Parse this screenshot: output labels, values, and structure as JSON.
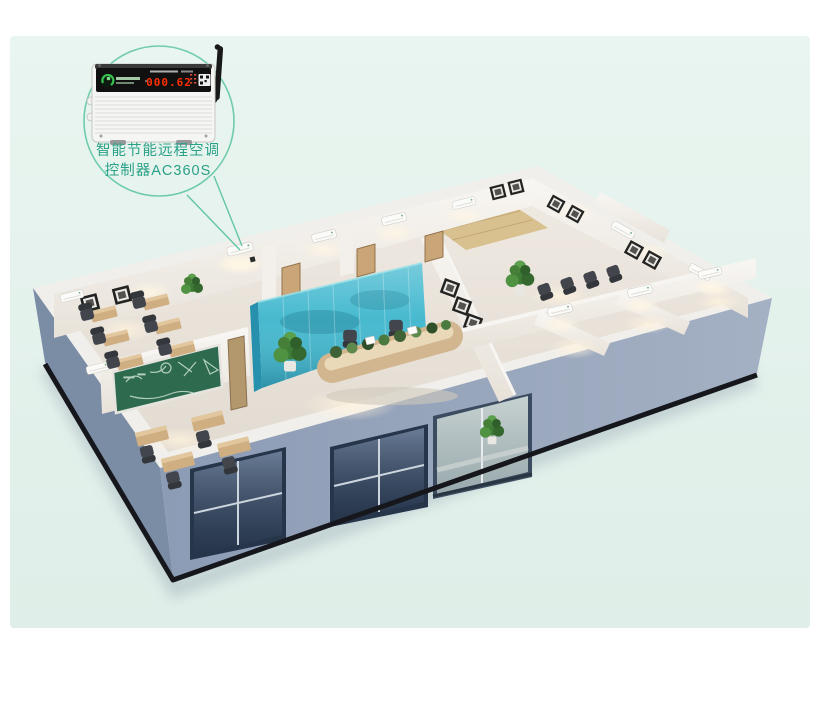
{
  "page": {
    "width": 820,
    "height": 716,
    "outer_background": "#ffffff",
    "panel_background": "#e4f2ed"
  },
  "callout": {
    "label_line1": "智能节能远程空调",
    "label_line2": "控制器AC360S",
    "label_color": "#2aa187",
    "line_color": "#62c6a5"
  },
  "device": {
    "name": "ac-remote-controller",
    "display_value": "000.62",
    "display_color": "#ff2e00",
    "logo_color": "#35c24d",
    "body_color": "#f5f5f3",
    "panel_color": "#101010",
    "antenna_color": "#191919"
  },
  "scene": {
    "type": "3d-office-floorplan-render",
    "colors": {
      "facade_front": "#96a5bd",
      "facade_left": "#7b8ca5",
      "wall_top": "#f1efeb",
      "wall_face": "#f6f4f1",
      "floor": "#e9e4dd",
      "wood_floor": "#d9c08f",
      "glass_wall": "#3db6cd",
      "glass_wall_dark": "#2791ad",
      "chalkboard": "#2e6a4d",
      "window_glass": "#5d6e88",
      "window_frame": "#26354a",
      "entrance_glass": "#b9c8c9",
      "desk_wood": "#d2b690",
      "chair": "#42464c",
      "plant": "#3f7c38",
      "plinth": "#16171c",
      "shadow": "#93a2b1"
    }
  }
}
